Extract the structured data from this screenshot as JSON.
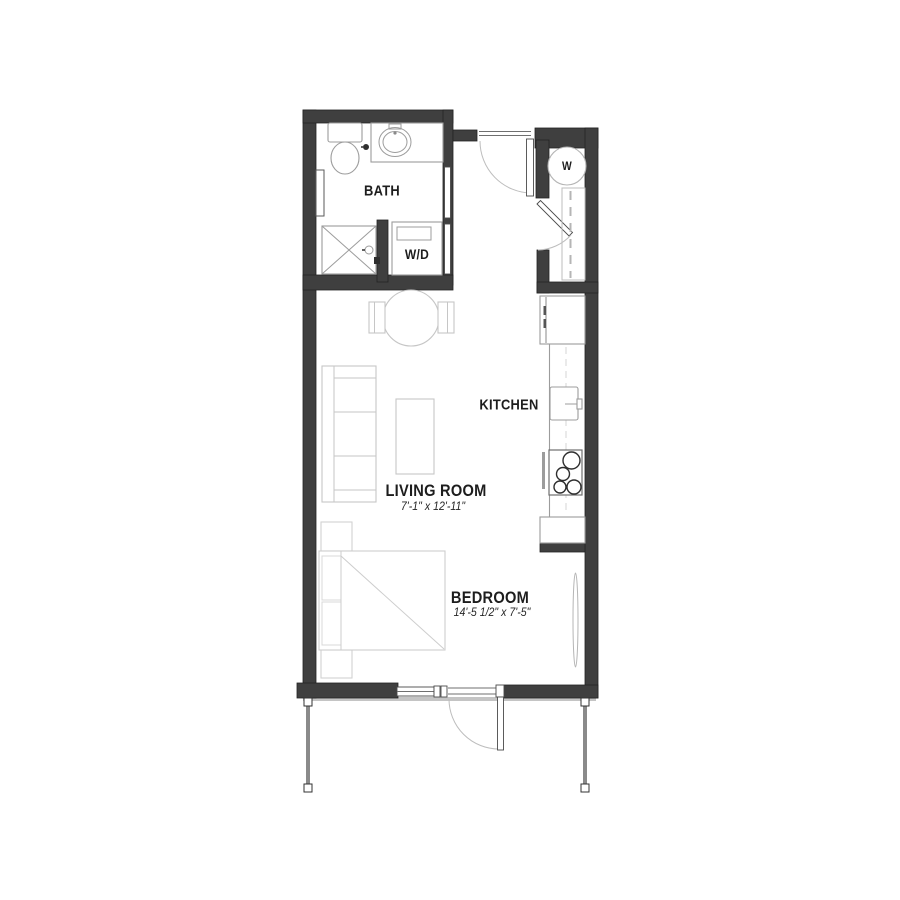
{
  "title": "Studio apartment floor plan",
  "rooms": {
    "bath": {
      "label": "BATH"
    },
    "laundry": {
      "label": "W/D"
    },
    "kitchen": {
      "label": "KITCHEN"
    },
    "living_room": {
      "label": "LIVING ROOM",
      "dimensions": "7'-1\" x 12'-11\""
    },
    "bedroom": {
      "label": "BEDROOM",
      "dimensions": "14'-5 1/2\" x 7'-5\""
    },
    "water_heater": {
      "label": "W"
    }
  },
  "colors": {
    "wall": "#3f3f3f",
    "fixture_line": "#9c9c9c",
    "furniture_line": "#c6c6c6",
    "door_arc": "#bdbdbd",
    "text": "#1d1d1d",
    "background": "#ffffff"
  }
}
